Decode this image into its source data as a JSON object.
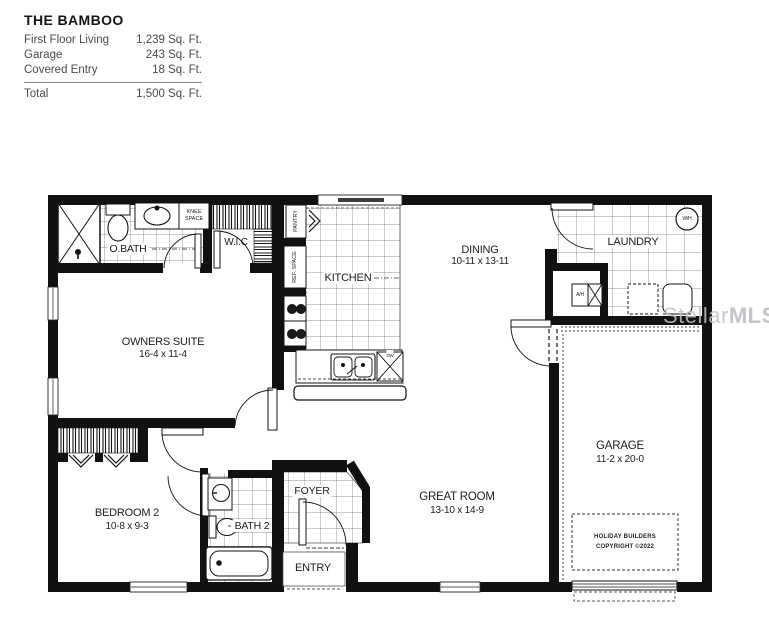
{
  "header": {
    "title": "THE BAMBOO",
    "rows": [
      {
        "label": "First Floor Living",
        "value": "1,239 Sq. Ft."
      },
      {
        "label": "Garage",
        "value": "243 Sq. Ft."
      },
      {
        "label": "Covered Entry",
        "value": "18 Sq. Ft."
      }
    ],
    "total": {
      "label": "Total",
      "value": "1,500 Sq. Ft."
    }
  },
  "plan": {
    "rooms": {
      "owners_suite": {
        "name": "OWNERS SUITE",
        "dims": "16-4 x 11-4"
      },
      "obath": {
        "name": "O.BATH"
      },
      "wic": {
        "name": "W.I.C"
      },
      "knee_space": {
        "line1": "KNEE",
        "line2": "SPACE"
      },
      "pantry": {
        "name": "PANTRY"
      },
      "ref_space": {
        "name": "REF. SPACE"
      },
      "kitchen": {
        "name": "KITCHEN"
      },
      "dining": {
        "name": "DINING",
        "dims": "10-11 x 13-11"
      },
      "laundry": {
        "name": "LAUNDRY"
      },
      "garage": {
        "name": "GARAGE",
        "dims": "11-2 x 20-0"
      },
      "great_room": {
        "name": "GREAT ROOM",
        "dims": "13-10 x 14-9"
      },
      "foyer": {
        "name": "FOYER"
      },
      "entry": {
        "name": "ENTRY"
      },
      "bath2": {
        "name": "BATH 2"
      },
      "bedroom2": {
        "name": "BEDROOM 2",
        "dims": "10-8 x 9-3"
      }
    },
    "appliances": {
      "water_heater": "W/H",
      "air_handler": "A/H",
      "dishwasher": "DW"
    },
    "copyright": {
      "line1": "HOLIDAY BUILDERS",
      "line2": "COPYRIGHT ©2022"
    },
    "watermark": {
      "part1": "Stellar",
      "part2": "MLS"
    },
    "colors": {
      "wall": "#111111",
      "tile_line": "#6f6f6f",
      "watermark": "#c0c0c6"
    }
  }
}
